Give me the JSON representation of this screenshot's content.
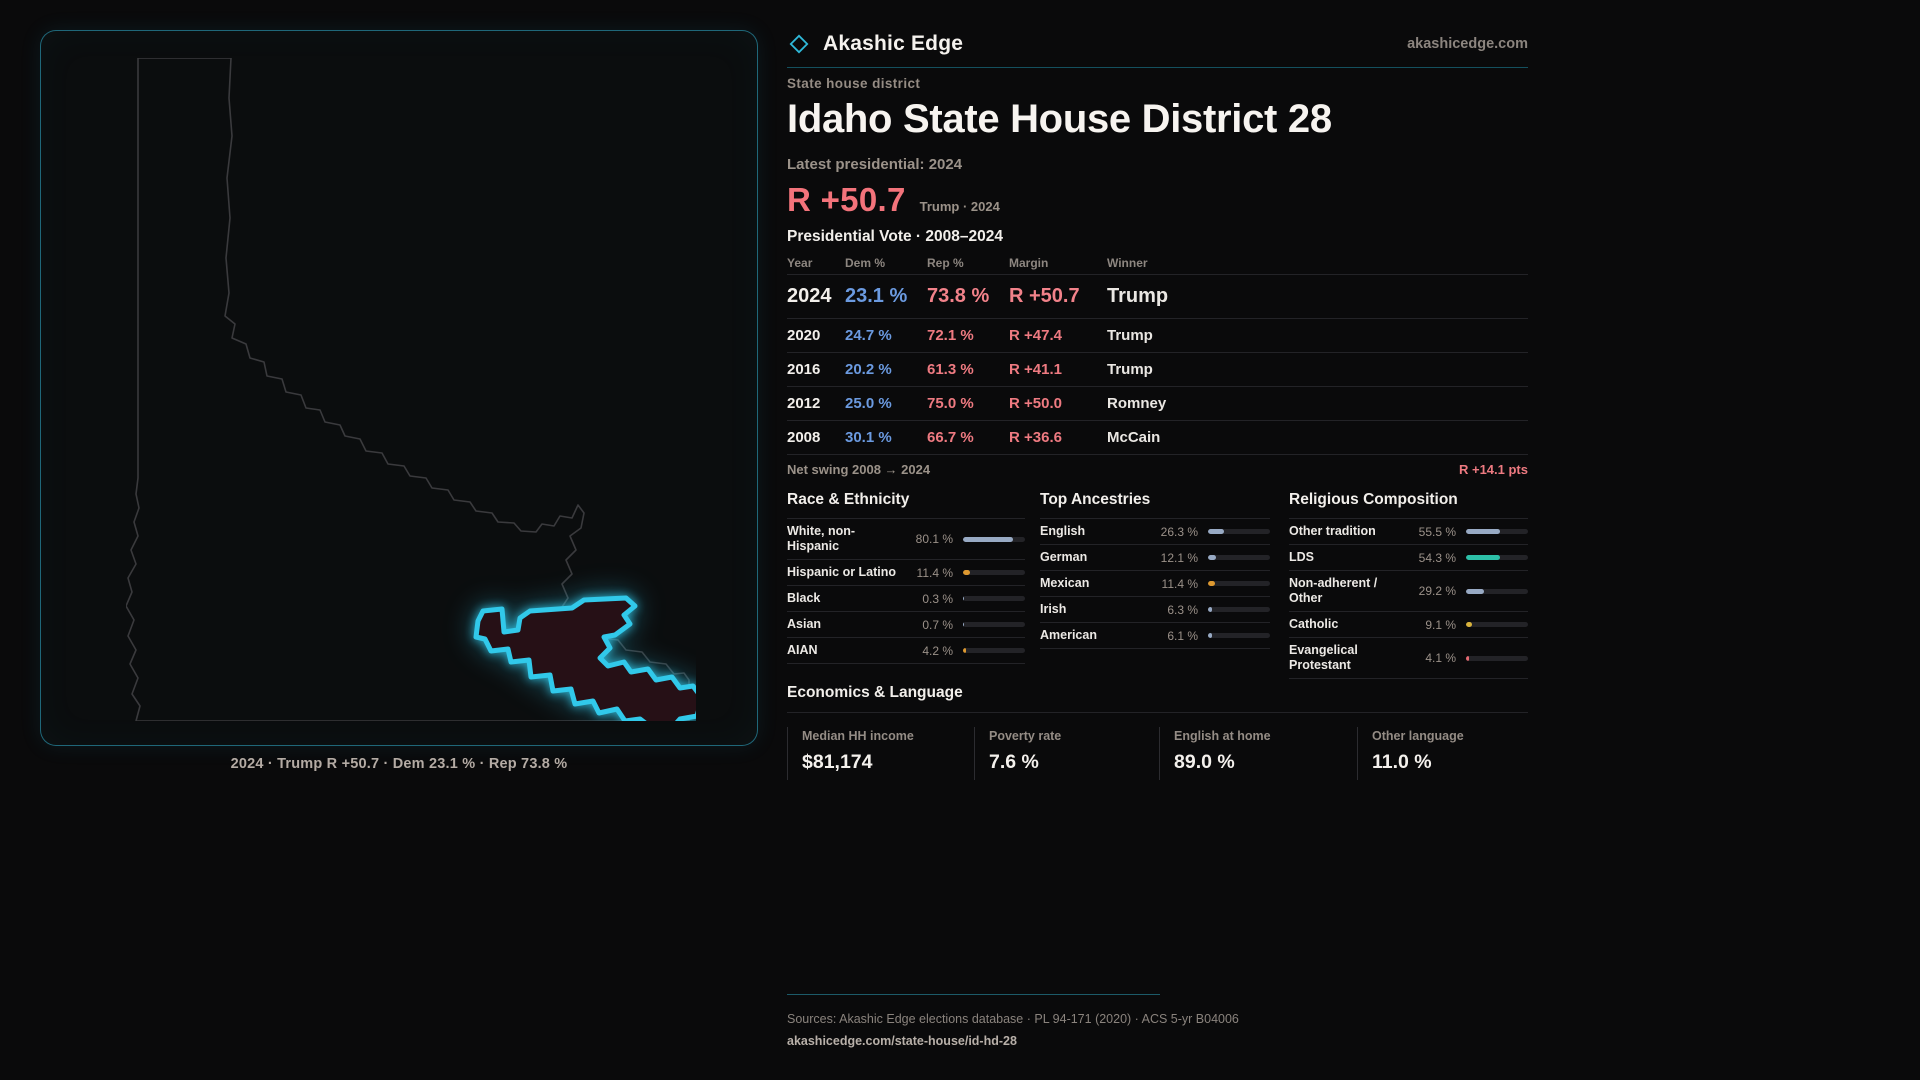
{
  "brand": {
    "name": "Akashic Edge",
    "site": "akashicedge.com",
    "icon": "diamond-icon"
  },
  "colors": {
    "accent_cyan": "#31c9ea",
    "dem_blue": "#6b9ae0",
    "rep_red": "#ee7a81",
    "bar_neutral": "#98aac4",
    "bar_orange": "#de9930",
    "bar_teal": "#2dc0a8",
    "bar_gold": "#d9b33c",
    "bar_red": "#e66a72"
  },
  "header": {
    "category": "State house district",
    "title": "Idaho State House District 28",
    "latest_label": "Latest presidential: 2024",
    "margin_big": "R +50.7",
    "margin_context": "Trump · 2024"
  },
  "map": {
    "caption": "2024 · Trump R +50.7 · Dem 23.1 % · Rep 73.8 %"
  },
  "presidential_table": {
    "title": "Presidential Vote · 2008–2024",
    "columns": [
      "Year",
      "Dem %",
      "Rep %",
      "Margin",
      "Winner"
    ],
    "rows": [
      {
        "year": "2024",
        "dem": "23.1 %",
        "rep": "73.8 %",
        "margin": "R +50.7",
        "winner": "Trump"
      },
      {
        "year": "2020",
        "dem": "24.7 %",
        "rep": "72.1 %",
        "margin": "R +47.4",
        "winner": "Trump"
      },
      {
        "year": "2016",
        "dem": "20.2 %",
        "rep": "61.3 %",
        "margin": "R +41.1",
        "winner": "Trump"
      },
      {
        "year": "2012",
        "dem": "25.0 %",
        "rep": "75.0 %",
        "margin": "R +50.0",
        "winner": "Romney"
      },
      {
        "year": "2008",
        "dem": "30.1 %",
        "rep": "66.7 %",
        "margin": "R +36.6",
        "winner": "McCain"
      }
    ],
    "net_swing_label": "Net swing 2008 → 2024",
    "net_swing_value": "R +14.1 pts"
  },
  "sections": {
    "race": {
      "title": "Race & Ethnicity",
      "rows": [
        {
          "label": "White, non-Hispanic",
          "value": "80.1 %",
          "pct": 80.1,
          "color": "#98aac4"
        },
        {
          "label": "Hispanic or Latino",
          "value": "11.4 %",
          "pct": 11.4,
          "color": "#de9930"
        },
        {
          "label": "Black",
          "value": "0.3 %",
          "pct": 0.3,
          "color": "#98aac4"
        },
        {
          "label": "Asian",
          "value": "0.7 %",
          "pct": 0.7,
          "color": "#98aac4"
        },
        {
          "label": "AIAN",
          "value": "4.2 %",
          "pct": 4.2,
          "color": "#de9930"
        }
      ]
    },
    "ancestries": {
      "title": "Top Ancestries",
      "rows": [
        {
          "label": "English",
          "value": "26.3 %",
          "pct": 26.3,
          "color": "#98aac4"
        },
        {
          "label": "German",
          "value": "12.1 %",
          "pct": 12.1,
          "color": "#98aac4"
        },
        {
          "label": "Mexican",
          "value": "11.4 %",
          "pct": 11.4,
          "color": "#de9930"
        },
        {
          "label": "Irish",
          "value": "6.3 %",
          "pct": 6.3,
          "color": "#98aac4"
        },
        {
          "label": "American",
          "value": "6.1 %",
          "pct": 6.1,
          "color": "#98aac4"
        }
      ]
    },
    "religion": {
      "title": "Religious Composition",
      "rows": [
        {
          "label": "Other tradition",
          "value": "55.5 %",
          "pct": 55.5,
          "color": "#98aac4"
        },
        {
          "label": "LDS",
          "value": "54.3 %",
          "pct": 54.3,
          "color": "#2dc0a8"
        },
        {
          "label": "Non-adherent / Other",
          "value": "29.2 %",
          "pct": 29.2,
          "color": "#98aac4"
        },
        {
          "label": "Catholic",
          "value": "9.1 %",
          "pct": 9.1,
          "color": "#d9b33c"
        },
        {
          "label": "Evangelical Protestant",
          "value": "4.1 %",
          "pct": 4.1,
          "color": "#e66a72"
        }
      ]
    }
  },
  "economics": {
    "title": "Economics & Language",
    "stats": [
      {
        "label": "Median HH income",
        "value": "$81,174"
      },
      {
        "label": "Poverty rate",
        "value": "7.6 %"
      },
      {
        "label": "English at home",
        "value": "89.0 %"
      },
      {
        "label": "Other language",
        "value": "11.0 %"
      }
    ]
  },
  "footer": {
    "sources": "Sources: Akashic Edge elections database · PL 94-171 (2020) · ACS 5-yr B04006",
    "url": "akashicedge.com/state-house/id-hd-28"
  }
}
